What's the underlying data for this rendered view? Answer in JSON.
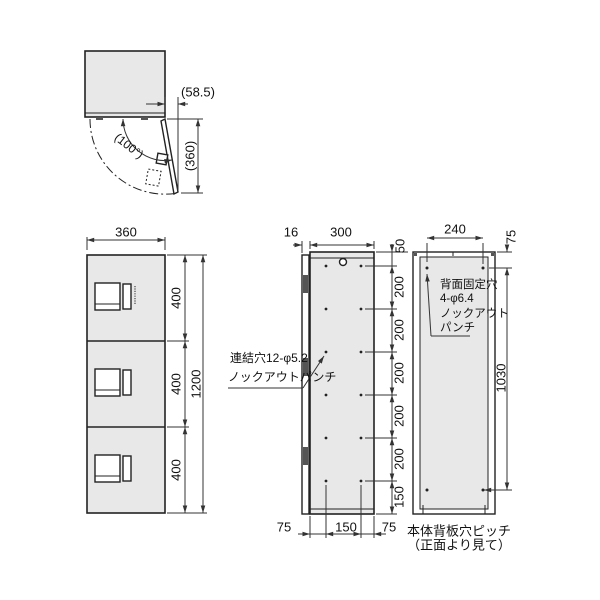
{
  "drawing_title": "locker-unit-dimension-drawing",
  "colors": {
    "panel_fill": "#e8e8e8",
    "line": "#222222",
    "dim_line": "#333333"
  },
  "views": {
    "top_view": {
      "dims": {
        "door_projection": "(58.5)",
        "door_width_open": "(360)",
        "open_angle": "(100°)"
      }
    },
    "front_view": {
      "dims": {
        "width": "360",
        "section_heights": [
          "400",
          "400",
          "400"
        ],
        "total_height": "1200"
      }
    },
    "side_view": {
      "dims": {
        "door_thickness": "16",
        "body_depth": "300",
        "top_offset": "50",
        "pitches": [
          "200",
          "200",
          "200",
          "200",
          "200"
        ],
        "bottom_offset": "150",
        "bottom_margins": [
          "75",
          "150",
          "75"
        ]
      },
      "annotation": {
        "line1": "連結穴12-φ5.2",
        "line2": "ノックアウトパンチ"
      }
    },
    "back_view": {
      "dims": {
        "hole_span": "240",
        "top_offset": "75",
        "hole_pitch": "1030"
      },
      "annotation": {
        "line1": "背面固定穴",
        "line2": "4-φ6.4",
        "line3": "ノックアウト",
        "line4": "パンチ"
      },
      "caption": {
        "line1": "本体背板穴ピッチ",
        "line2": "（正面より見て）"
      }
    }
  }
}
